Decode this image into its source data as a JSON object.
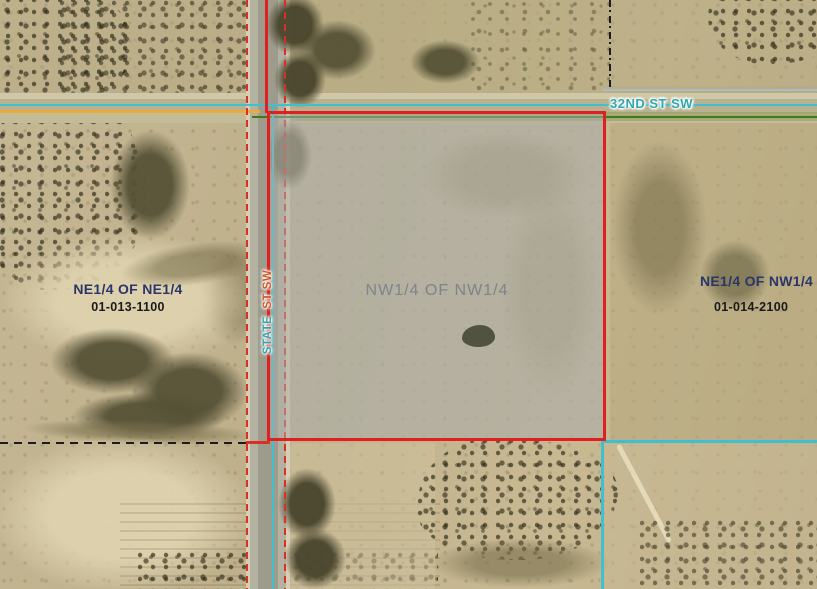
{
  "streets": {
    "cross_street": {
      "label": "32ND ST SW",
      "color": "#2fa8ad"
    },
    "main_street": {
      "word_bottom": "STATE",
      "word_top": "ST SW",
      "color_bottom": "#2fa8ad",
      "color_top": "#cf5a28"
    }
  },
  "selected_parcel": {
    "quarter_label": "NW1/4 OF NW1/4",
    "boundary_color": "#e02020",
    "fill_color": "rgba(173,172,166,0.52)",
    "label_color": "#767c8a"
  },
  "adjacent_parcels": [
    {
      "quarter_label": "NE1/4 OF NE1/4",
      "parcel_id": "01-013-1100"
    },
    {
      "quarter_label": "NE1/4 OF NW1/4",
      "parcel_id": "01-014-2100"
    }
  ],
  "boundary_colors": {
    "selected_red": "#e02020",
    "parcel_cyan": "#3fbfcf",
    "right_of_way_red_dash": "#d93025",
    "section_orange": "#ecaa3c",
    "section_green": "#3e7a1c",
    "survey_black": "#1c1c1c",
    "survey_bluegray": "#a9bcc8"
  }
}
